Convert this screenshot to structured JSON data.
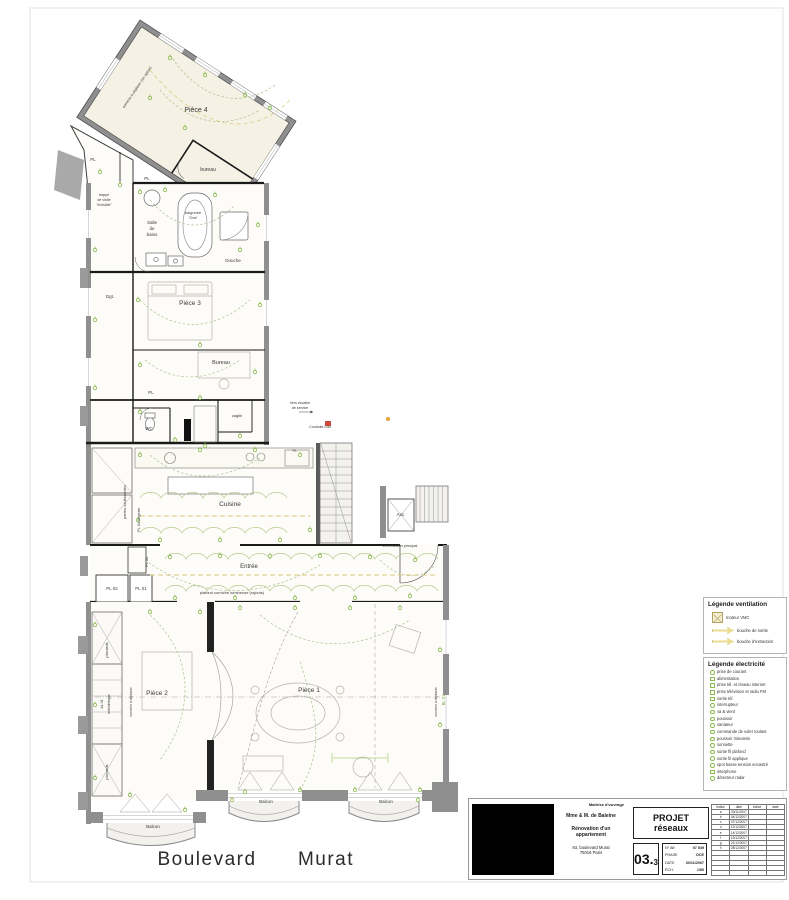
{
  "plan": {
    "labels": [
      {
        "text": "Pièce 4"
      },
      {
        "text": "bureau"
      },
      {
        "text": "corniche à déplacer (en option)"
      },
      {
        "text": "PL"
      },
      {
        "text": "PL"
      },
      {
        "text": "trappe"
      },
      {
        "text": "de visite"
      },
      {
        "text": "\"invisible\""
      },
      {
        "text": "Salle"
      },
      {
        "text": "de"
      },
      {
        "text": "bains"
      },
      {
        "text": "baignoire"
      },
      {
        "text": "'Ove'"
      },
      {
        "text": "Douche"
      },
      {
        "text": "Dgt."
      },
      {
        "text": "Pièce 3"
      },
      {
        "text": "Bureau"
      },
      {
        "text": "PL"
      },
      {
        "text": "WC"
      },
      {
        "text": "cagibi"
      },
      {
        "text": "Vers escalier"
      },
      {
        "text": "de service"
      },
      {
        "text": "Conduits Gaz"
      },
      {
        "text": "PL"
      },
      {
        "text": "Cuisine"
      },
      {
        "text": "portes coulissantes"
      },
      {
        "text": "PL 04 lingerie"
      },
      {
        "text": "Asc."
      },
      {
        "text": "vers escalier principal"
      },
      {
        "text": "PL 03"
      },
      {
        "text": "PL 02"
      },
      {
        "text": "PL 01"
      },
      {
        "text": "Entrée"
      },
      {
        "text": "plafond corniche lumineuse (rajouts)"
      },
      {
        "text": "placards"
      },
      {
        "text": "AL 01"
      },
      {
        "text": "bibliothèque"
      },
      {
        "text": "corniche à déplacer"
      },
      {
        "text": "Pièce 2"
      },
      {
        "text": "Pièce 1"
      },
      {
        "text": "corniche à déplacer"
      },
      {
        "text": "BL 01"
      },
      {
        "text": "Balcon"
      },
      {
        "text": "Balcon"
      },
      {
        "text": "Balcon"
      },
      {
        "text": "Boulevard"
      },
      {
        "text": "Murat"
      },
      {
        "text": "placards"
      }
    ]
  },
  "legend_ventilation": {
    "title": "Légende ventilation",
    "items": [
      {
        "label": "moteur VMC"
      },
      {
        "label": "bouche de sortie"
      },
      {
        "label": "bouche d'extraction"
      }
    ]
  },
  "legend_electricite": {
    "title": "Légende électricité",
    "items": [
      {
        "label": "prise de courant"
      },
      {
        "label": "alimentation"
      },
      {
        "label": "prise tél. et réseau internet"
      },
      {
        "label": "prise télévision et radio FM"
      },
      {
        "label": "sortie tél"
      },
      {
        "label": "interrupteur"
      },
      {
        "label": "va & vient"
      },
      {
        "label": "poussoir"
      },
      {
        "label": "variateur"
      },
      {
        "label": "commande de volet roulant"
      },
      {
        "label": "poussoir minuterie"
      },
      {
        "label": "sonnette"
      },
      {
        "label": "sortie fil plafond"
      },
      {
        "label": "sortie fil applique"
      },
      {
        "label": "spot basse tension encastré"
      },
      {
        "label": "interphone"
      },
      {
        "label": "détecteur radar"
      }
    ]
  },
  "title_block": {
    "client_label": "Maîtrise d'ouvrage",
    "client_name": "Mme & M. de Baleine",
    "project_line1": "Rénovation d'un",
    "project_line2": "appartement",
    "address_line1": "93, boulevard Murat",
    "address_line2": "75016 Paris",
    "doc_type": "PROJET",
    "doc_subject": "réseaux",
    "sheet_number": "03.",
    "sheet_index": "3",
    "fields": [
      {
        "label": "N° Aff.",
        "value": "07 549"
      },
      {
        "label": "PHASE",
        "value": "DCE"
      },
      {
        "label": "DATE",
        "value": "30/11/2007"
      },
      {
        "label": "ÉCH.",
        "value": "1/50"
      }
    ],
    "revisions": {
      "headers": [
        "indice",
        "date",
        "indice",
        "date"
      ],
      "rows": [
        [
          "a",
          "30/11/2007"
        ],
        [
          "b",
          "04/12/2007"
        ],
        [
          "c",
          "07/12/2007"
        ],
        [
          "d",
          "12/12/2007"
        ],
        [
          "e",
          "14/12/2007"
        ],
        [
          "f",
          "19/12/2007"
        ],
        [
          "g",
          "21/12/2007"
        ],
        [
          "h",
          "28/12/2007"
        ]
      ]
    }
  },
  "colors": {
    "accent_green": "#8ab94e",
    "cornice_yellow": "#d9c878",
    "wall_gray": "#8f8f8f"
  }
}
